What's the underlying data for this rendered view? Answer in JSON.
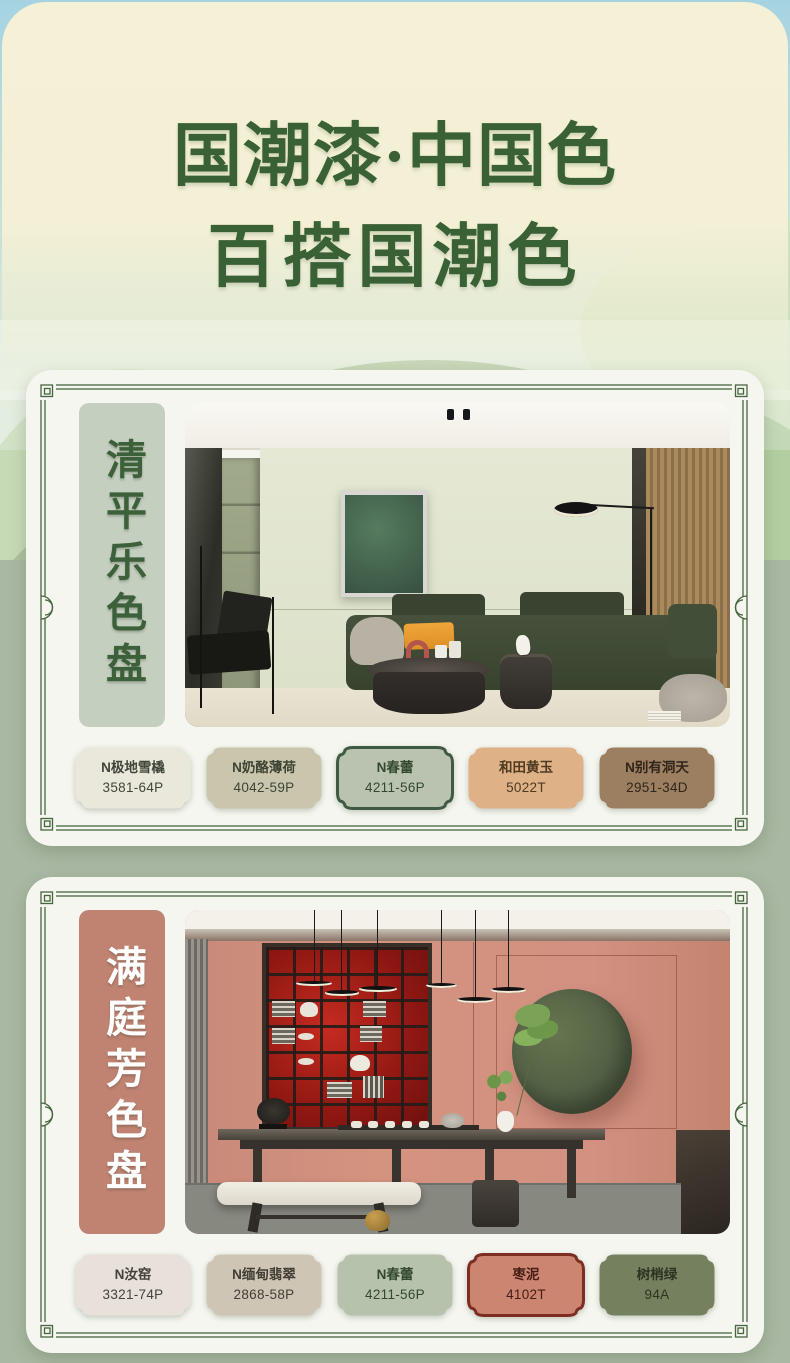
{
  "theme": {
    "title_color": "#3a6135",
    "frame_color": "#47653f",
    "card_bg": "#f4f6ef",
    "backdrop_green": "#a9b8a2",
    "sky_blue": "#a6d3e2",
    "header_cream": "#f4f1d7"
  },
  "header": {
    "title_line1": "国潮漆·中国色",
    "title_line2": "百搭国潮色"
  },
  "palettes": [
    {
      "title": "清平乐色盘",
      "label_bg": "#c5cfc0",
      "label_color": "#3c6039",
      "swatches": [
        {
          "name": "N极地雪橇",
          "code": "3581-64P",
          "fill": "#eae8db",
          "stroke": "none",
          "text": "#3f453a"
        },
        {
          "name": "N奶酪薄荷",
          "code": "4042-59P",
          "fill": "#c9c6ad",
          "stroke": "none",
          "text": "#3e4434"
        },
        {
          "name": "N春蕾",
          "code": "4211-56P",
          "fill": "#b9c3b0",
          "stroke": "#3f5a43",
          "text": "#33492f"
        },
        {
          "name": "和田黄玉",
          "code": "5022T",
          "fill": "#deb286",
          "stroke": "none",
          "text": "#4d3a22"
        },
        {
          "name": "N别有洞天",
          "code": "2951-34D",
          "fill": "#9c7e61",
          "stroke": "none",
          "text": "#30251a"
        }
      ]
    },
    {
      "title": "满庭芳色盘",
      "label_bg": "#c08372",
      "label_color": "#ffffff",
      "swatches": [
        {
          "name": "N汝窑",
          "code": "3321-74P",
          "fill": "#e8e1da",
          "stroke": "none",
          "text": "#46413c"
        },
        {
          "name": "N缅甸翡翠",
          "code": "2868-58P",
          "fill": "#cfc5b5",
          "stroke": "none",
          "text": "#413e35"
        },
        {
          "name": "N春蕾",
          "code": "4211-56P",
          "fill": "#b6c2ab",
          "stroke": "none",
          "text": "#33492f"
        },
        {
          "name": "枣泥",
          "code": "4102T",
          "fill": "#cb8571",
          "stroke": "#7e2d22",
          "text": "#461d14"
        },
        {
          "name": "树梢绿",
          "code": "94A",
          "fill": "#75805e",
          "stroke": "none",
          "text": "#2c3322"
        }
      ]
    }
  ]
}
